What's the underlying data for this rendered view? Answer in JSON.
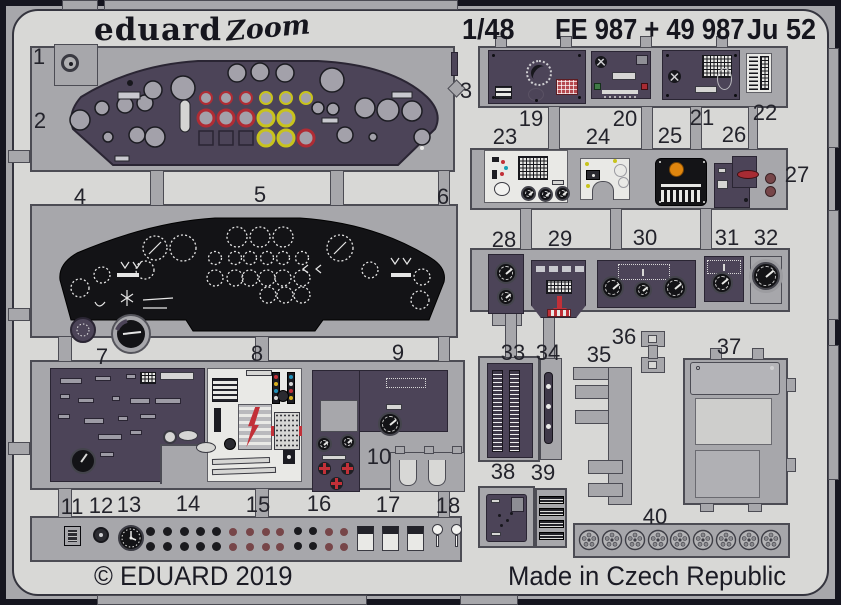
{
  "header": {
    "brand": "eduard",
    "series": "Zoom",
    "scale": "1/48",
    "codes": "FE 987 + 49 987",
    "model": "Ju 52"
  },
  "footer": {
    "copyright": "© EDUARD 2019",
    "made_in": "Made in Czech Republic"
  },
  "colors": {
    "frame": "#15151f",
    "sheet": "#d8d8d6",
    "fret_metal": "#a7a7ab",
    "panel_purple": "#4c4458",
    "panel_black": "#131316",
    "panel_light": "#e9e9e6",
    "accent_red": "#b02c34",
    "accent_yellow": "#c8c31c",
    "accent_orange": "#e0860e",
    "accent_maroon": "#774649"
  },
  "part_labels": [
    "1",
    "2",
    "3",
    "4",
    "5",
    "6",
    "7",
    "8",
    "9",
    "10",
    "11",
    "12",
    "13",
    "14",
    "15",
    "16",
    "17",
    "18",
    "19",
    "20",
    "21",
    "22",
    "23",
    "24",
    "25",
    "26",
    "27",
    "28",
    "29",
    "30",
    "31",
    "32",
    "33",
    "34",
    "35",
    "36",
    "37",
    "38",
    "39",
    "40"
  ]
}
